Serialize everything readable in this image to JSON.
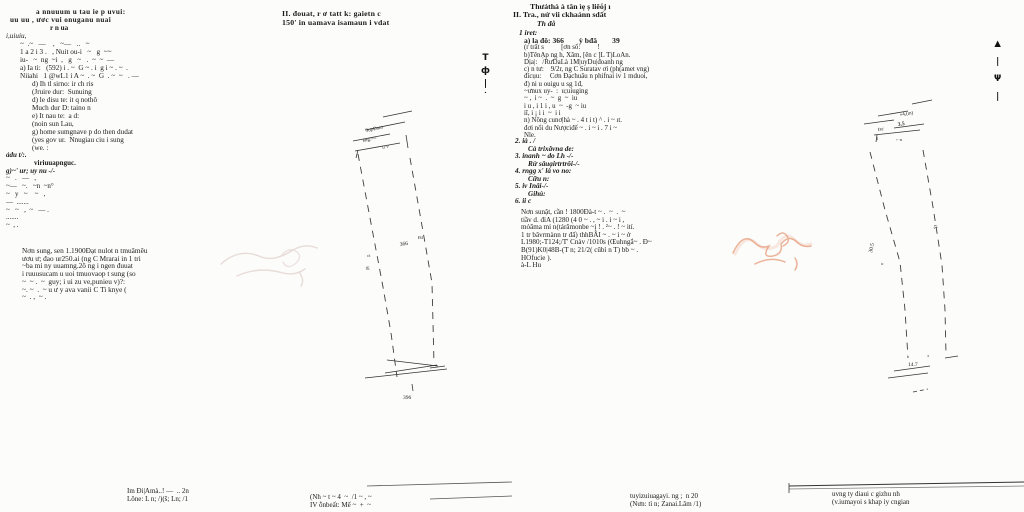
{
  "document": {
    "kind": "scanned land certificate, two pages"
  },
  "colors": {
    "paper": "#fcfcfa",
    "ink": "#1a1a1a",
    "diagram_line": "#3f3f3f",
    "stamp_left": "#c7a9a1",
    "stamp_right": "#e0855c"
  },
  "left_page": {
    "header": [
      "II. đouat, r ơ tatt k: gaietn c",
      "150' in uamava isamaun i vdat"
    ],
    "top_block": [
      "a nnuuum u tau ie p uvui:",
      "uu uu , ươc vui onuganu nuai",
      "r n ua",
      "i,uiuiu,",
      "~  .~   —    ,   ~—   ..   ~",
      "1 a 2 i 3 .   , Nuit ou-i   ~   g  ~~",
      "iu-   ~  ng  ~i  ,   g   ~   .  ~  ~  —",
      "a) Ia ti:   (592) i . ~  G ~ . i  g i ~ . ~  .",
      "Niiahi   1 @wL1 i A ~  . ~  G  . ~  ~   . —",
      "d) Ih tl sirno: ir ch ris",
      "(Jruire dur:  Sunuing",
      "d) le disu te: it q nothô",
      "Much dur D: taino n",
      "e) It nau te:  a d:",
      "(noin sun Lau,",
      "g) home sumgnave p do then dudat",
      "(yes gov ur.  Nnugiau ciu i sung",
      "(we. :"
    ],
    "mid_block": [
      "ảdu t/:.",
      "viriuuapnguc.",
      "g)~' ur; uy nu -/-",
      "~   .   —   ,",
      "~—   ~.   ~n  ~n°",
      "~   y   ~    ~   ,",
      "—  .......",
      "~   ~   ,  ~   — .",
      ".......",
      "~  , ."
    ],
    "para_block": [
      "Nơn sung, sen 1.1900Đạt nulot n tmuâmêu",
      "ươu ư; đao ur250.ai (ng C Mrarai in 1 tri",
      "~ba mi ny uuamng.2ô ng i ngen đuuat",
      "i ruuusucam u uoi tmuovaop t sung (so",
      "~  ~ .  ~  guy; i ui zu ve,punieu v)?:",
      "~. ~  .  ~ u ư y ava vanii C Ti knye (",
      "~  . ,  ~ ."
    ],
    "fold_marks": [
      "T",
      "ф",
      "|",
      "˙"
    ],
    "diagram": {
      "top_label_1": "ЗưpĐam",
      "top_label_2": "eng:==",
      "top_label_3": "1r v",
      "parcel_number": "366",
      "side_label_1": "Đ4",
      "side_label_2": "ca",
      "side_label_3": "Œ",
      "bottom_label": "396"
    },
    "footer_left": [
      "Im Đi|Amà..! —  .. 2n",
      "Lône: L n; /)(š; Ln; /1"
    ],
    "footer_right": [
      "(Nh ~ t ~ 4  ~  /1 ~ , ~",
      "IV ỗnbeất: Mế ~  +  ~"
    ]
  },
  "right_page": {
    "header": [
      "Thưảthà à tân ìẹ ṣ liêόj ı",
      "II. Tra., nử vii ckhaảnn sdất",
      "Th đå",
      "1 iret:"
    ],
    "body_block": [
      "a) la đô: 366        ỳ bđâ        39",
      "(r trất s          [ơn số:          !",
      "b)TênẠp ng h, Xăm, [ên c ]L T)LoAn.",
      "Dịa|:   /RưDaLà 1M|uyDu|đoanh ng",
      "c) n tư:    9/2r, ng C Suratav ơi (ph(amet vng)",
      "đícụu:     Cơn Đạchuâu n phifnai iv 1 mduoi,",
      "đ) ni u ouigu u sg 1đ,",
      "~ưnux uy-  :  u;uiuging",
      "~ ,  i ~  .  ~  g  ~  iu",
      "i u , i 1 i , u  ~  -g  ~ iu",
      "iī, i ¡ i i  ~  i i",
      "n) Nông cunơ|hà ~ . 4 t i t) ^ . i ~ ıt.",
      "đơi nổi du Nượciđế ~ . i ~ i . 7 i ~",
      "Nle."
    ],
    "list_block": [
      "2. ià . /",
      "Cà trixăvna de:",
      "3. inanh ~ do Lh -/-",
      "Rừ sâuạirtrtrôi-/-",
      "4. rngg x' là vo no:",
      "Cữu n:",
      "5. iv Inâi-/-",
      "Gihú:",
      "6. ii c"
    ],
    "para_block": [
      "Nơn sunật, cần ! 1800Đà-t ~ .  ~  .  ~",
      "tiầv d. đỉA (1280 (4 0 ~ . , ~ i . i ~ i ,",
      "mỏăma mi n(tárămonbe ~ị ! . ²~ . ! ~ ití.",
      "1 tr bâvrmànn tr đấ) thhBÂI ~ . ~ i ~ ở",
      "L1980;-T124;/T' Cnàv /1010s (Œuhngắ~ . Đ~",
      "B(91)K0|48B-(T n; 21/2( cũbì n T) bb ~ .",
      "HOfucie ).",
      "à-L Hu"
    ],
    "fold_marks": [
      "▲",
      "|",
      "Ψ",
      "|"
    ],
    "diagram": {
      "top_label_m": "«4,(m)",
      "top_dim": "3.5",
      "top_label_d": "Đư",
      "top_tick": "1",
      "top_label_n": "⌐ n",
      "side_label_e": "ɛ|,",
      "side_dim": "30.5",
      "side_label_a": "ɐ",
      "bottom_dim": "14.7",
      "bottom_label_c": "ɔ"
    },
    "footer_left": [
      "tuyizuiuagayi. ng ;  n 20",
      "(Nưn: tì n; Zanai.Lâm /1)"
    ],
    "footer_right": [
      "uvng ty diaui c gizhu nh",
      "(v.iumayoi s khap iy cngian"
    ]
  }
}
